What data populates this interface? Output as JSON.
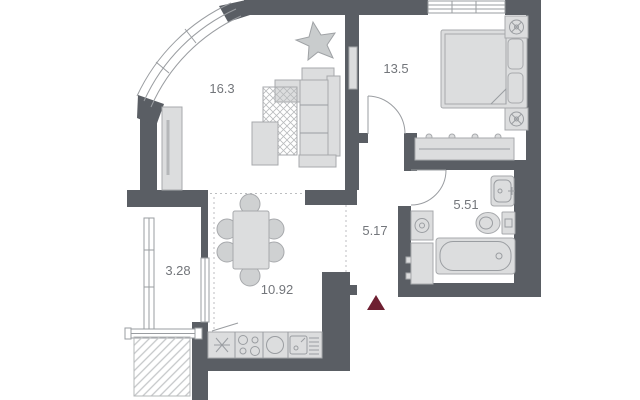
{
  "plan": {
    "rooms": {
      "living": {
        "area": "16.3"
      },
      "bedroom": {
        "area": "13.5"
      },
      "bathroom": {
        "area": "5.51"
      },
      "hallway": {
        "area": "5.17"
      },
      "kitchen_dining": {
        "area": "10.92"
      },
      "balcony": {
        "area": "3.28"
      }
    },
    "markers": {
      "entrance_icon": "entrance-triangle"
    },
    "colors": {
      "wall": "#5a5e64",
      "furniture_fill": "#dcddde",
      "furniture_stroke": "#a7a9ac",
      "label_text": "#73767b",
      "entrance_marker": "#6e1f31",
      "background": "#ffffff"
    }
  }
}
